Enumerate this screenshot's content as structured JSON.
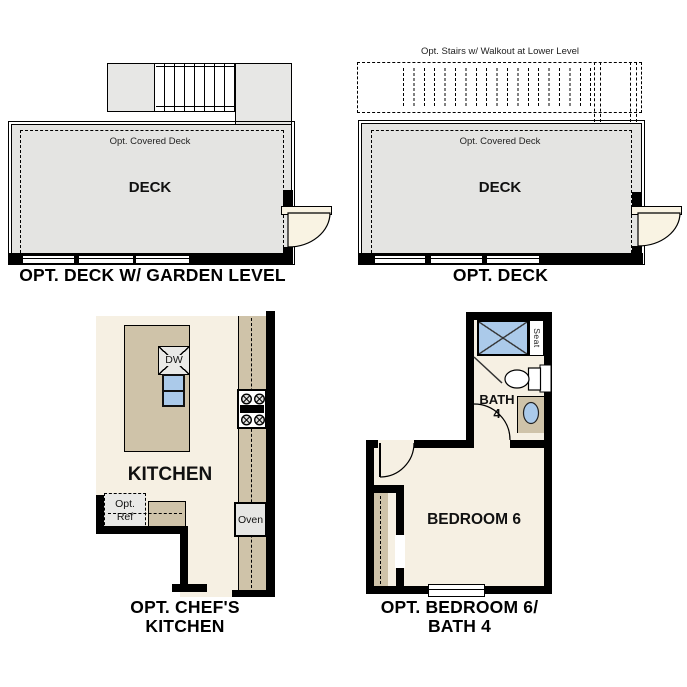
{
  "page": {
    "background": "#ffffff"
  },
  "plans": {
    "deck_garden_level": {
      "title": "OPT. DECK W/ GARDEN LEVEL",
      "deck_label": "DECK",
      "covered_deck_label": "Opt. Covered Deck"
    },
    "deck": {
      "title": "OPT. DECK",
      "deck_label": "DECK",
      "covered_deck_label": "Opt. Covered Deck",
      "stairs_note": "Opt. Stairs w/ Walkout at Lower Level"
    },
    "chefs_kitchen": {
      "title_line1": "OPT. CHEF'S",
      "title_line2": "KITCHEN",
      "room_label": "KITCHEN",
      "dishwasher_label": "DW",
      "oven_label": "Oven",
      "fridge_label_line1": "Opt.",
      "fridge_label_line2": "Ref"
    },
    "bedroom6_bath4": {
      "title_line1": "OPT. BEDROOM 6/",
      "title_line2": "BATH 4",
      "room_label": "BEDROOM 6",
      "bath_label_line1": "BATH",
      "bath_label_line2": "4",
      "seat_label": "Seat"
    }
  },
  "colors": {
    "wall": "#000000",
    "deck_fill": "#e4e4e2",
    "landing_fill": "#e7e7e5",
    "floor_fill": "#f6f0e3",
    "cabinet_fill": "#cfc3a9",
    "fixture_blue": "#abcaea",
    "appliance_fill": "#e9e9e7",
    "door_fill": "#f9f3e3"
  }
}
